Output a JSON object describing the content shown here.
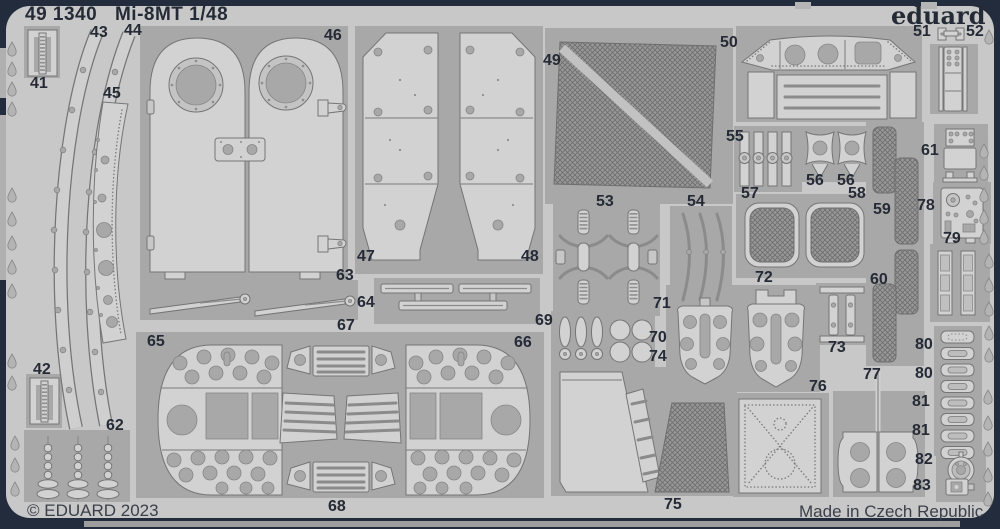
{
  "header": {
    "catalog_number": "49 1340",
    "title": "Mi-8MT 1/48",
    "brand": "eduard"
  },
  "footer": {
    "copyright": "© EDUARD 2023",
    "origin": "Made in Czech Republic"
  },
  "sheet": {
    "kind": "photo-etched parts fret",
    "part_numbers_visible": [
      "41",
      "42",
      "43",
      "44",
      "45",
      "46",
      "47",
      "48",
      "49",
      "50",
      "51",
      "52",
      "53",
      "54",
      "55",
      "56",
      "57",
      "58",
      "59",
      "60",
      "61",
      "62",
      "63",
      "64",
      "65",
      "66",
      "67",
      "68",
      "69",
      "70",
      "71",
      "72",
      "73",
      "74",
      "75",
      "76",
      "77",
      "78",
      "79",
      "80",
      "81",
      "82",
      "83"
    ]
  },
  "colors": {
    "background": "#232c3c",
    "sheet": "#c8c8c8",
    "waste": "#a8a8a8",
    "part": "#d2d2d2",
    "mesh": "#8f8f8f",
    "ink": "#252b36"
  },
  "part_labels": [
    {
      "text": "41",
      "x": 30,
      "y": 76
    },
    {
      "text": "42",
      "x": 33,
      "y": 362
    },
    {
      "text": "43",
      "x": 90,
      "y": 25
    },
    {
      "text": "44",
      "x": 124,
      "y": 23
    },
    {
      "text": "45",
      "x": 103,
      "y": 86
    },
    {
      "text": "46",
      "x": 324,
      "y": 28
    },
    {
      "text": "47",
      "x": 357,
      "y": 249
    },
    {
      "text": "48",
      "x": 521,
      "y": 249
    },
    {
      "text": "49",
      "x": 543,
      "y": 53
    },
    {
      "text": "50",
      "x": 720,
      "y": 35
    },
    {
      "text": "51",
      "x": 913,
      "y": 24
    },
    {
      "text": "52",
      "x": 966,
      "y": 24
    },
    {
      "text": "53",
      "x": 596,
      "y": 194
    },
    {
      "text": "54",
      "x": 687,
      "y": 194
    },
    {
      "text": "55",
      "x": 726,
      "y": 129
    },
    {
      "text": "56",
      "x": 806,
      "y": 173
    },
    {
      "text": "56",
      "x": 837,
      "y": 173
    },
    {
      "text": "57",
      "x": 741,
      "y": 186
    },
    {
      "text": "58",
      "x": 848,
      "y": 186
    },
    {
      "text": "59",
      "x": 873,
      "y": 202
    },
    {
      "text": "60",
      "x": 870,
      "y": 272
    },
    {
      "text": "61",
      "x": 921,
      "y": 143
    },
    {
      "text": "62",
      "x": 106,
      "y": 418
    },
    {
      "text": "63",
      "x": 336,
      "y": 268
    },
    {
      "text": "64",
      "x": 357,
      "y": 295
    },
    {
      "text": "65",
      "x": 147,
      "y": 334
    },
    {
      "text": "66",
      "x": 514,
      "y": 335
    },
    {
      "text": "67",
      "x": 337,
      "y": 318
    },
    {
      "text": "68",
      "x": 328,
      "y": 499
    },
    {
      "text": "69",
      "x": 535,
      "y": 313
    },
    {
      "text": "70",
      "x": 649,
      "y": 330
    },
    {
      "text": "71",
      "x": 653,
      "y": 296
    },
    {
      "text": "72",
      "x": 755,
      "y": 270
    },
    {
      "text": "73",
      "x": 828,
      "y": 340
    },
    {
      "text": "74",
      "x": 649,
      "y": 349
    },
    {
      "text": "75",
      "x": 664,
      "y": 497
    },
    {
      "text": "76",
      "x": 809,
      "y": 379
    },
    {
      "text": "77",
      "x": 863,
      "y": 367
    },
    {
      "text": "78",
      "x": 917,
      "y": 198
    },
    {
      "text": "79",
      "x": 943,
      "y": 231
    },
    {
      "text": "80",
      "x": 915,
      "y": 337
    },
    {
      "text": "80",
      "x": 915,
      "y": 366
    },
    {
      "text": "81",
      "x": 912,
      "y": 394
    },
    {
      "text": "81",
      "x": 912,
      "y": 423
    },
    {
      "text": "82",
      "x": 915,
      "y": 452
    },
    {
      "text": "83",
      "x": 913,
      "y": 478
    }
  ]
}
